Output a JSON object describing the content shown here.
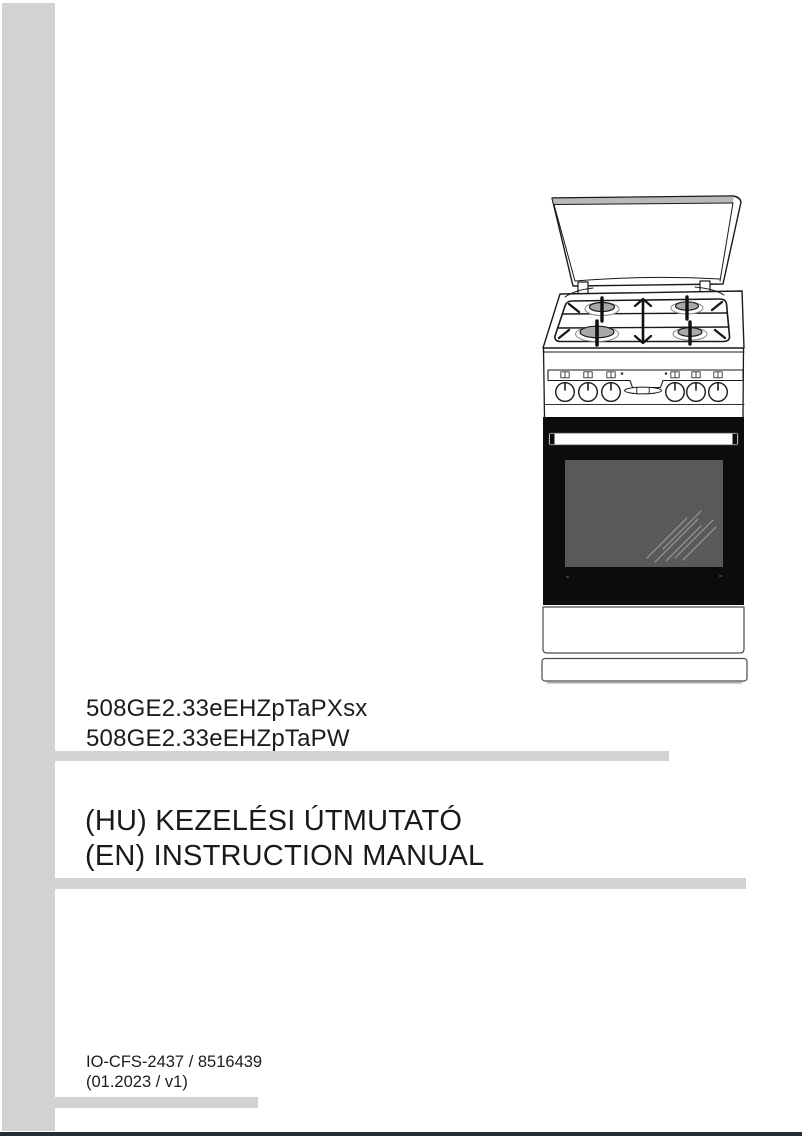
{
  "page": {
    "type": "instruction-manual-cover",
    "background": "#ffffff",
    "accent_bar_color": "#d2d2d2",
    "bottom_edge_color": "#272c35",
    "text_color": "#1c1c1c"
  },
  "models": {
    "line1": "508GE2.33eEHZpTaPXsx",
    "line2": "508GE2.33eEHZpTaPW"
  },
  "title": {
    "hu": "(HU) KEZELÉSI ÚTMUTATÓ",
    "en": "(EN) INSTRUCTION MANUAL"
  },
  "footer": {
    "doc_code": "IO-CFS-2437 / 8516439",
    "version": "(01.2023 / v1)"
  },
  "illustration": {
    "name": "freestanding-gas-cooker",
    "description": "Freestanding gas cooker with opened lid, 4-burner gas hob with pan supports and double-headed arrow, control panel with 6 knobs, oven door with window reflection, storage drawer and plinth"
  }
}
